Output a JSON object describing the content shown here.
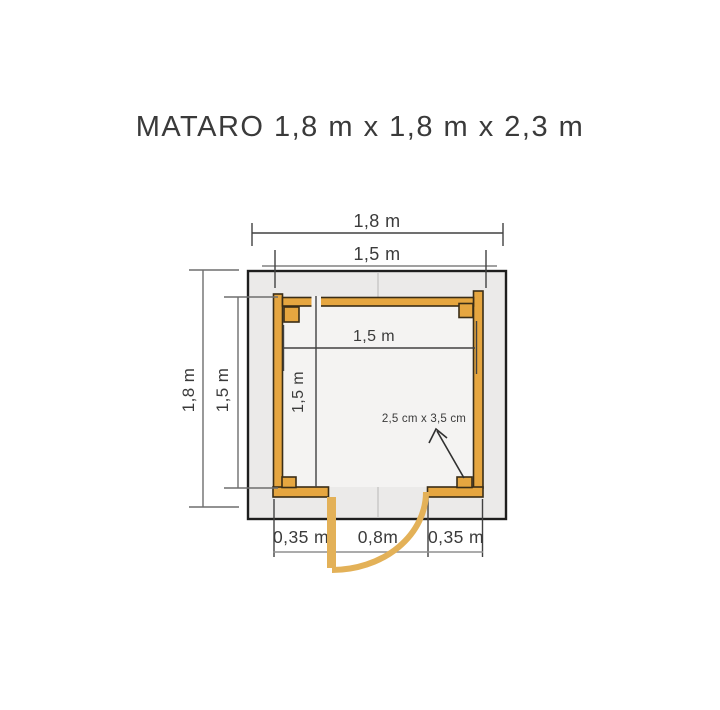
{
  "title": "MATARO  1,8 m x 1,8 m x 2,3 m",
  "dimensions": {
    "roof_width": "1,8 m",
    "wall_width": "1,5 m",
    "roof_depth": "1,8 m",
    "wall_depth": "1,5 m",
    "inner_width": "1,5 m",
    "inner_depth": "1,5 m",
    "door_left_offset": "0,35 m",
    "door_width": "0,8m",
    "door_right_offset": "0,35 m"
  },
  "annotation": {
    "post_section": "2,5 cm x 3,5 cm"
  },
  "colors": {
    "wall_fill": "#e6a640",
    "wall_outline": "#3a2d17",
    "door_tan": "#e3b158",
    "base_fill": "#ebeae9",
    "room_fill": "#f4f3f2",
    "base_outline": "#1e1e1e",
    "dim_dark": "#414141",
    "dim_gray": "#8f8f8f",
    "text": "#3b3b3b"
  }
}
